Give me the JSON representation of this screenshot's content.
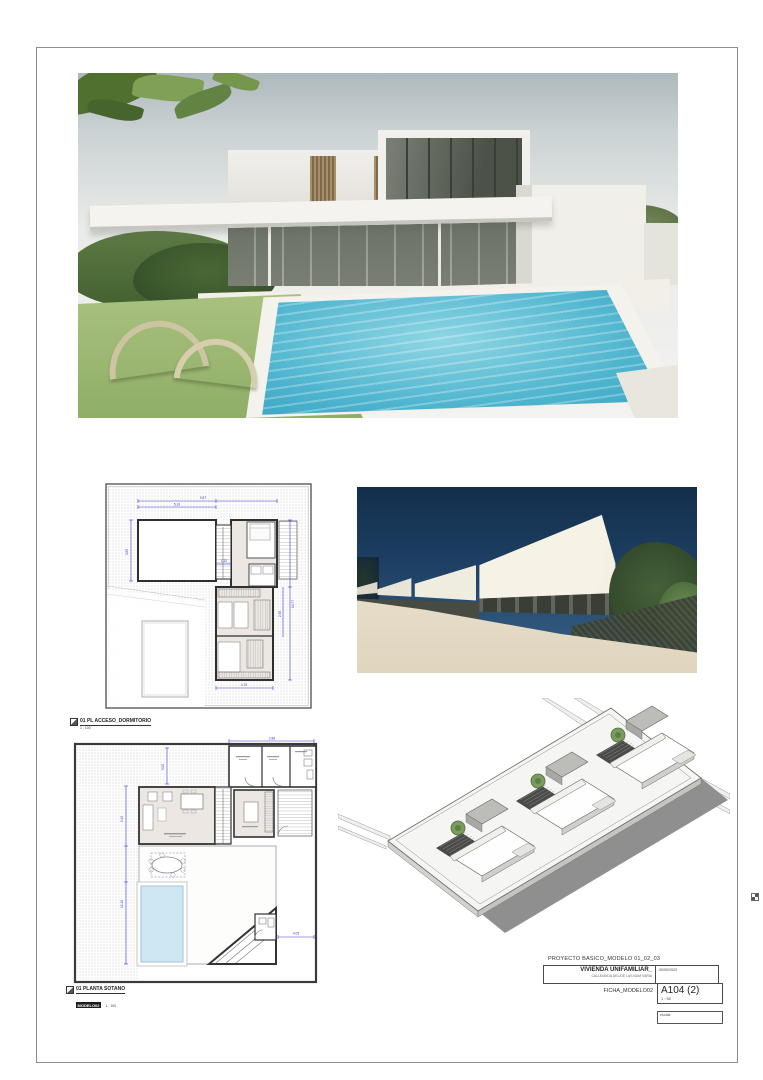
{
  "title_block": {
    "project_title": "PROYECTO BASICO_MODELO 01_02_03",
    "project_name": "VIVIENDA UNIFAMILIAR_",
    "project_address": "CALLE/AVDA DEL/DE LAS NUM VARIA",
    "date": "00/00/2023",
    "sheet_name": "FICHA_MODELO02",
    "sheet_number": "A104 (2)",
    "sheet_scale": "1 : 50",
    "footer_note": "escala"
  },
  "view_labels": {
    "access_plan": {
      "ref": "1",
      "title": "01 PL ACCESO_DORMITORIO",
      "scale": "1 : 100"
    },
    "basement_plan": {
      "ref": "1",
      "title": "01 PLANTA SOTANO",
      "badge": "MODELO02",
      "scale": "1 : 100"
    }
  },
  "dimensions": {
    "access_plan": {
      "top": "9.87",
      "top_inner": "5.10",
      "left": "3.85",
      "right": "10.77",
      "right_inner": "2.98",
      "bottom": "4.75",
      "mid": "1.32"
    },
    "basement_plan": {
      "top": "2.88",
      "left": "12.10",
      "left_inner": "3.45",
      "bottom": "4.05",
      "inner": "5.00"
    }
  },
  "colors": {
    "dimension_blue": "#3a3acc",
    "pool_water": "#4fb5cf",
    "plan_pool_fill": "#cfe7f3",
    "evening_sky": "#1f4166",
    "lawn_green": "#9ab873",
    "axon_shadow": "#8f8f8f"
  }
}
